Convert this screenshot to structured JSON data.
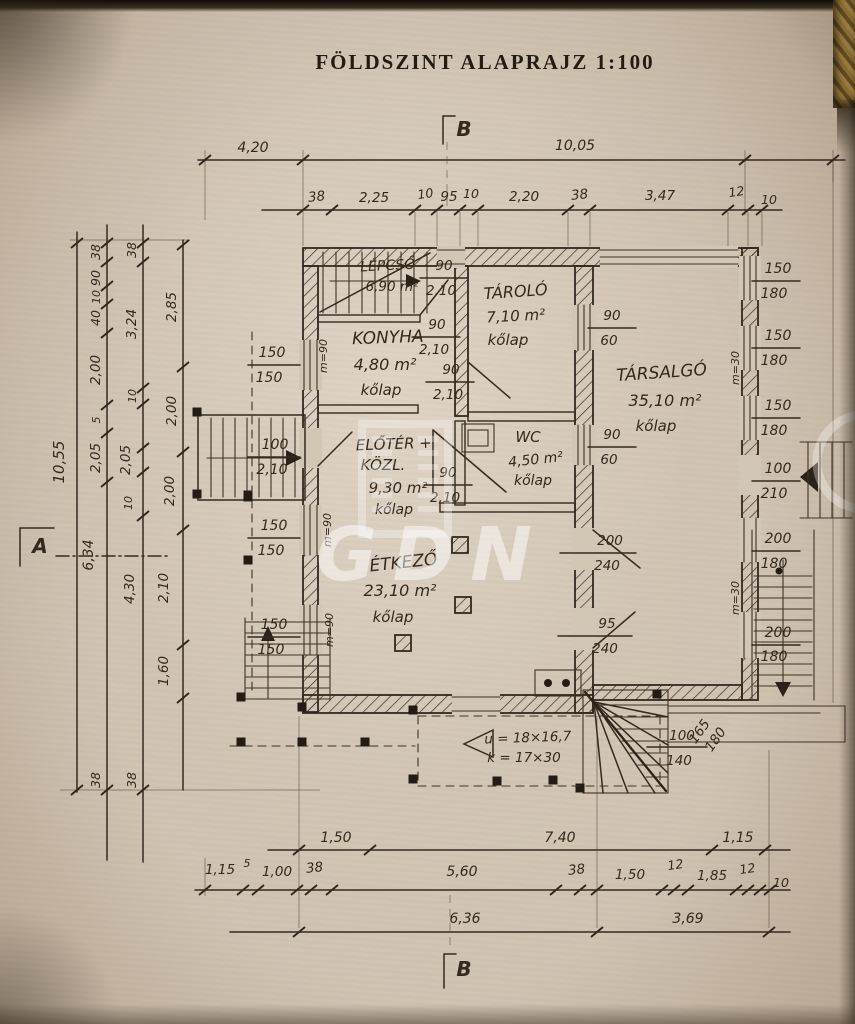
{
  "title": "FÖLDSZINT ALAPRAJZ 1:100",
  "watermark": {
    "text": "GDN"
  },
  "section_marks": {
    "top": "B",
    "bottom": "B",
    "left": "A"
  },
  "rooms": {
    "lepcso": {
      "name": "LÉPCSŐ",
      "area": "6,90 m²"
    },
    "konyha": {
      "name": "KONYHA",
      "area": "4,80 m²",
      "floor": "kőlap"
    },
    "tarolo": {
      "name": "TÁROLÓ",
      "area": "7,10 m²",
      "floor": "kőlap"
    },
    "tarsalgo": {
      "name": "TÁRSALGÓ",
      "area": "35,10 m²",
      "floor": "kőlap"
    },
    "eloter": {
      "name": "ELŐTÉR +",
      "name2": "KÖZL.",
      "area": "9,30 m²",
      "floor": "kőlap"
    },
    "wc": {
      "name": "WC",
      "area": "4,50 m²",
      "floor": "kőlap"
    },
    "etkezo": {
      "name": "ÉTKEZŐ",
      "area": "23,10 m²",
      "floor": "kőlap"
    }
  },
  "dims": {
    "top1": [
      "4,20",
      "10,05"
    ],
    "top2": [
      "38",
      "2,25",
      "10",
      "95",
      "10",
      "2,20",
      "38",
      "3,47",
      "12",
      "10"
    ],
    "left_total": "10,55",
    "left_a": [
      "38",
      "90",
      "10",
      "40",
      "2,00",
      "5",
      "2,05",
      "6,34",
      "38"
    ],
    "left_b": [
      "38",
      "3,24",
      "10",
      "2,05",
      "10",
      "4,30",
      "38"
    ],
    "left_c": [
      "2,85",
      "2,00",
      "2,00",
      "2,10",
      "1,60"
    ],
    "bottom1": [
      "1,50",
      "7,40",
      "1,15"
    ],
    "bottom2": [
      "1,15",
      "5",
      "1,00",
      "38",
      "5,60",
      "38",
      "1,50",
      "12",
      "1,85",
      "12",
      "10"
    ],
    "bottom3": [
      "6,36",
      "3,69"
    ]
  },
  "openings": {
    "right": [
      [
        "150",
        "180"
      ],
      [
        "150",
        "180"
      ],
      [
        "150",
        "180"
      ],
      [
        "100",
        "210"
      ],
      [
        "200",
        "180"
      ],
      [
        "200",
        "180"
      ],
      [
        "100",
        "140"
      ],
      [
        "165",
        "180"
      ]
    ],
    "left": [
      [
        "150",
        "150"
      ],
      [
        "100",
        "2,10"
      ],
      [
        "150",
        "150"
      ],
      [
        "150",
        "150"
      ]
    ],
    "inner": [
      [
        "90",
        "2,10"
      ],
      [
        "90",
        "2,10"
      ],
      [
        "90",
        "2,10"
      ],
      [
        "90",
        "60"
      ],
      [
        "90",
        "60"
      ],
      [
        "90",
        "2,10"
      ],
      [
        "200",
        "240"
      ],
      [
        "95",
        "240"
      ]
    ]
  },
  "annotations": {
    "parapet90": "m=90",
    "parapet30": "m=30",
    "stair_note1": "u = 18×16,7",
    "stair_note2": "k = 17×30"
  }
}
